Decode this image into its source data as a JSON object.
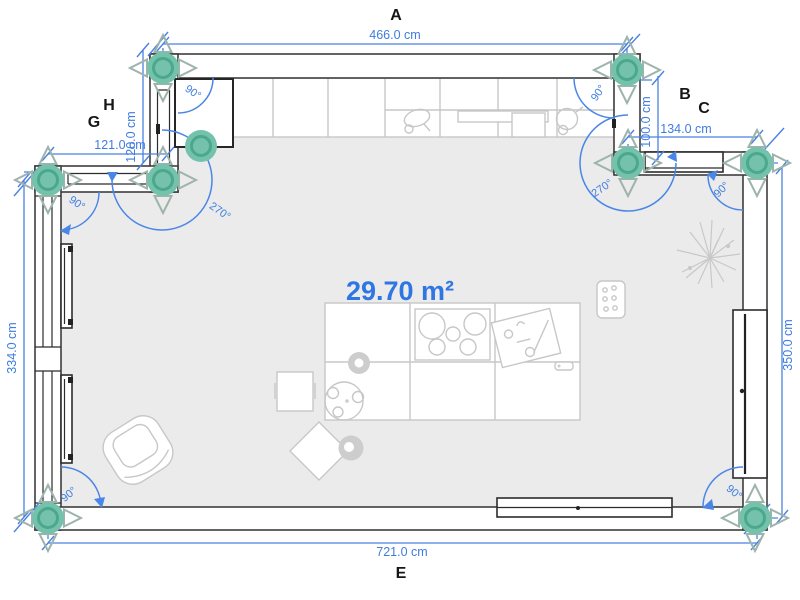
{
  "app": {
    "name": "floor-plan-editor"
  },
  "area": {
    "value": "29.70 m²"
  },
  "wall_labels": {
    "a": "A",
    "b": "B",
    "c": "C",
    "e": "E",
    "g": "G",
    "h": "H"
  },
  "dimensions": {
    "top": "466.0 cm",
    "bottom": "721.0 cm",
    "left": "334.0 cm",
    "right": "350.0 cm",
    "left_upper_horizontal": "121.0 cm",
    "left_upper_vertical": "120.0 cm",
    "right_upper_vertical": "100.0 cm",
    "right_upper_horizontal": "134.0 cm"
  },
  "angles": {
    "top_left_corner": "90°",
    "top_right_corner": "90°",
    "left_wall_top": "90°",
    "bottom_left_corner": "90°",
    "bottom_right_corner": "90°",
    "right_wall_top": "90°",
    "left_junction": "270°",
    "right_junction": "270°"
  },
  "colors": {
    "dimension_blue": "#3f7ce0",
    "area_blue": "#2e76e4",
    "handle_teal": "#74c2ab",
    "handle_ring": "#4ba88c",
    "arrow_outline": "#9db3ab",
    "wall_stroke": "#3e3e3e",
    "floor": "#ebebeb",
    "furniture_light": "#c7c7c7",
    "furniture_dark": "#2c2c2c"
  }
}
